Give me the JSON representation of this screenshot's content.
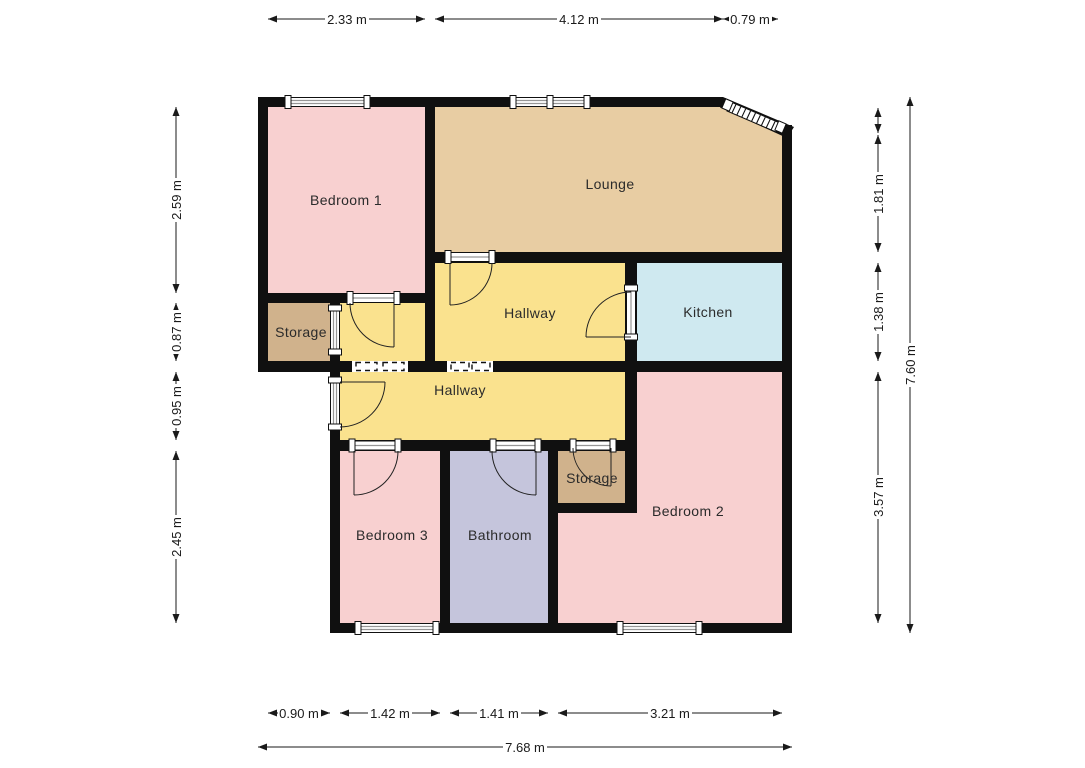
{
  "floorplan": {
    "title": "Flat floor plan",
    "rooms": [
      {
        "id": "bedroom-1",
        "label": "Bedroom 1",
        "color": "#f8d0d0"
      },
      {
        "id": "lounge",
        "label": "Lounge",
        "color": "#e8cda3"
      },
      {
        "id": "storage-upper",
        "label": "Storage",
        "color": "#d0b28c"
      },
      {
        "id": "hallway-upper",
        "label": "Hallway",
        "color": "#fae28e"
      },
      {
        "id": "kitchen",
        "label": "Kitchen",
        "color": "#cfe9f0"
      },
      {
        "id": "hallway-lower",
        "label": "Hallway",
        "color": "#fae28e"
      },
      {
        "id": "storage-lower",
        "label": "Storage",
        "color": "#d0b28c"
      },
      {
        "id": "bedroom-2",
        "label": "Bedroom 2",
        "color": "#f8d0d0"
      },
      {
        "id": "bedroom-3",
        "label": "Bedroom 3",
        "color": "#f8d0d0"
      },
      {
        "id": "bathroom",
        "label": "Bathroom",
        "color": "#c5c5dc"
      }
    ],
    "dimensions": {
      "top": [
        "2.33 m",
        "4.12 m",
        "0.79 m"
      ],
      "left": [
        "2.59 m",
        "0.87 m",
        "0.95 m",
        "2.45 m"
      ],
      "right": [
        "1.81 m",
        "1.38 m",
        "3.57 m"
      ],
      "right_total": "7.60 m",
      "bottom": [
        "0.90 m",
        "1.42 m",
        "1.41 m",
        "3.21 m"
      ],
      "bottom_total": "7.68 m"
    },
    "colors": {
      "background": "#ffffff",
      "wall": "#101010",
      "dimension_text": "#1a1a1a",
      "window_line": "#969696",
      "door_arc": "#222222",
      "room_pink": "#f8d0d0",
      "room_tan": "#e8cda3",
      "room_yellow": "#fae28e",
      "room_blue": "#cfe9f0",
      "room_brown": "#d0b28c",
      "room_lavender": "#c5c5dc"
    }
  }
}
